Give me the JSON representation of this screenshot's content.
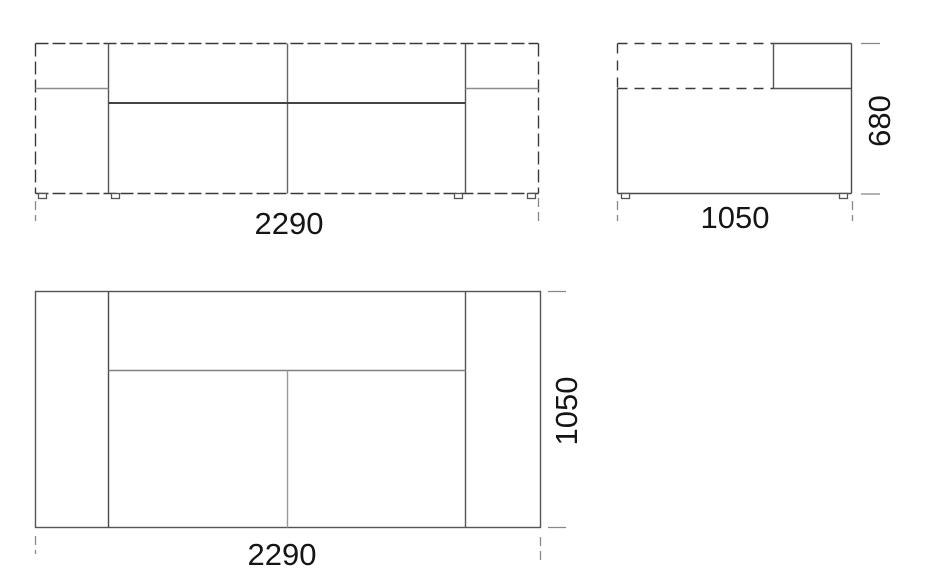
{
  "drawing": {
    "subject": "sofa-three-view-technical-drawing",
    "views": {
      "front": {
        "width_mm": "2290"
      },
      "side": {
        "depth_mm": "1050",
        "height_mm": "680"
      },
      "plan": {
        "width_mm": "2290",
        "depth_mm": "1050"
      }
    },
    "colors": {
      "background": "#ffffff",
      "outline_dashed": "#3a3a3a",
      "line_structural": "#555555",
      "line_seat": "#444444",
      "line_light": "#8c8c8c",
      "line_lighter": "#9a9a9a",
      "extension_line": "#888888",
      "dimension_text": "#151515"
    }
  }
}
